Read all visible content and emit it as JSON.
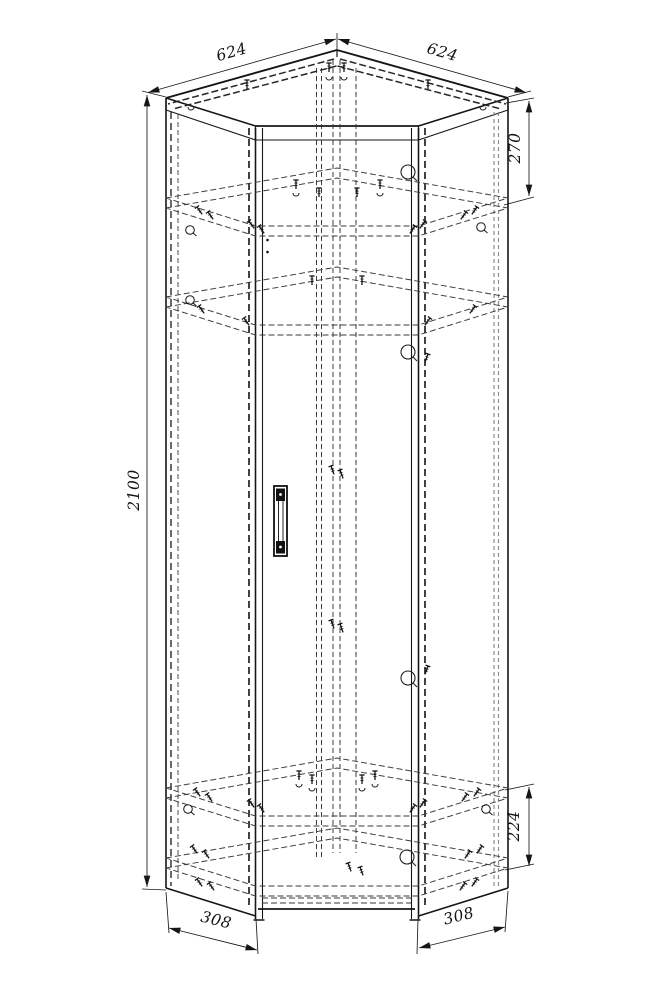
{
  "drawing": {
    "title": "corner-wardrobe-assembly-drawing",
    "subject": "corner wardrobe carcass, isometric assembly view",
    "dimensions": {
      "top_left": "624",
      "top_right": "624",
      "height": "2100",
      "right_upper": "270",
      "right_lower": "224",
      "bottom_left": "308",
      "bottom_right": "308"
    },
    "colors": {
      "background": "#ffffff",
      "line": "#161616",
      "hidden_line": "#3a3a3a",
      "light_line": "#8d8d8d"
    },
    "icons": {
      "screw": "screw-icon",
      "cam_lock": "cam-lock-icon",
      "hook": "dowel-hook-icon",
      "hole": "hole-mark",
      "handle": "door-handle"
    }
  }
}
